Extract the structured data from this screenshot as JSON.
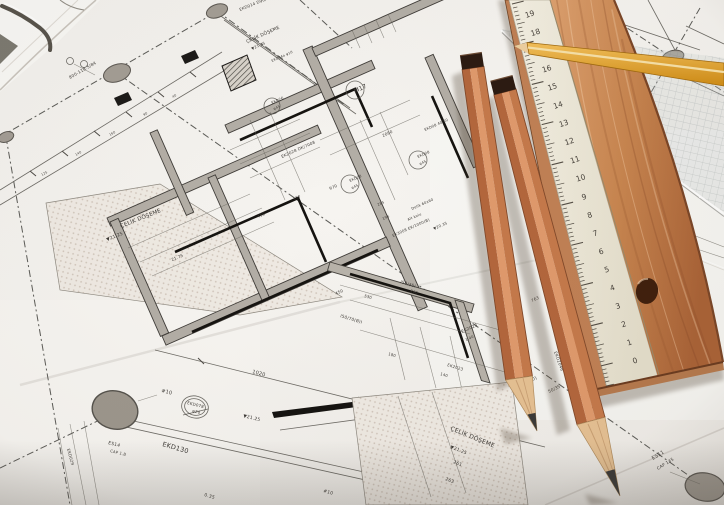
{
  "scene": {
    "width": 724,
    "height": 505,
    "subject": "architectural blueprint with pencils, wooden ruler, scale ruler and set square"
  },
  "colors": {
    "paper": "#f4f2ee",
    "line": "#55524c",
    "wall_fill": "#b3aea6",
    "pencil_left": "#b3663c",
    "pencil_mid": "#e09a6c",
    "pencil_right": "#c5794a",
    "pencil_cap": "#2b1a11",
    "cone_wood": "#e6c193",
    "graphite": "#3a3a38",
    "ruler_wood": "#c98a5e",
    "ruler_side": "#c08054",
    "scale_face": "#f1ecdd",
    "yellow_pencil": "#e8a83c"
  },
  "blueprint": {
    "plan_labels": [
      {
        "t": "EKD014 D90/75",
        "x": 240,
        "y": 11,
        "r": -22,
        "s": 4
      },
      {
        "t": "ÇELİK DÖŞEME",
        "x": 247,
        "y": 43,
        "r": -24,
        "s": 4.5
      },
      {
        "t": "▼21.25",
        "x": 252,
        "y": 50,
        "r": -24,
        "s": 3.8
      },
      {
        "t": "800-118.5/84",
        "x": 70,
        "y": 79,
        "r": -30,
        "s": 4.2
      },
      {
        "t": "M17",
        "x": 355,
        "y": 93,
        "r": -24,
        "s": 6
      },
      {
        "t": "EKD26",
        "x": 272,
        "y": 104,
        "r": -24,
        "s": 3.6
      },
      {
        "t": "φ45",
        "x": 274,
        "y": 110,
        "r": -24,
        "s": 3.4
      },
      {
        "t": "EKD08 40/50",
        "x": 425,
        "y": 131,
        "r": -24,
        "s": 3.6
      },
      {
        "t": "2060",
        "x": 383,
        "y": 137,
        "r": -24,
        "s": 4
      },
      {
        "t": "EK2028 DK/7008",
        "x": 282,
        "y": 158,
        "r": -24,
        "s": 4
      },
      {
        "t": "EKD04a φ10",
        "x": 272,
        "y": 62,
        "r": -24,
        "s": 3.4
      },
      {
        "t": "970",
        "x": 330,
        "y": 190,
        "r": -24,
        "s": 4
      },
      {
        "t": "EKD28",
        "x": 350,
        "y": 182,
        "r": -24,
        "s": 3.6
      },
      {
        "t": "φ45",
        "x": 352,
        "y": 189,
        "r": -24,
        "s": 3.4
      },
      {
        "t": "EKD08",
        "x": 418,
        "y": 158,
        "r": -24,
        "s": 3.6
      },
      {
        "t": "φ45",
        "x": 420,
        "y": 165,
        "r": -24,
        "s": 3.4
      },
      {
        "t": "ÇELİK DÖŞEME",
        "x": 121,
        "y": 228,
        "r": -22,
        "s": 5.5
      },
      {
        "t": "▼21.25",
        "x": 107,
        "y": 241,
        "r": -22,
        "s": 4.5
      },
      {
        "t": "450",
        "x": 258,
        "y": 218,
        "r": -24,
        "s": 4
      },
      {
        "t": "150",
        "x": 294,
        "y": 200,
        "r": -24,
        "s": 3.6
      },
      {
        "t": "285",
        "x": 378,
        "y": 206,
        "r": -24,
        "s": 3.6
      },
      {
        "t": "196",
        "x": 383,
        "y": 220,
        "r": -24,
        "s": 3.6
      },
      {
        "t": "Delik 60x60",
        "x": 412,
        "y": 210,
        "r": -24,
        "s": 3.6
      },
      {
        "t": "Alt kolu",
        "x": 408,
        "y": 221,
        "r": -24,
        "s": 3.6
      },
      {
        "t": "▼20.35",
        "x": 434,
        "y": 230,
        "r": -24,
        "s": 3.8
      },
      {
        "t": "EK3008 EK/1000(B)",
        "x": 393,
        "y": 237,
        "r": -24,
        "s": 3.8
      },
      {
        "t": "21.75",
        "x": 172,
        "y": 261,
        "r": -22,
        "s": 4
      },
      {
        "t": "450",
        "x": 336,
        "y": 295,
        "r": -24,
        "s": 4
      },
      {
        "t": "763",
        "x": 532,
        "y": 302,
        "r": -24,
        "s": 4
      },
      {
        "t": "EKD2046",
        "x": 554,
        "y": 352,
        "r": 70,
        "s": 4.2
      },
      {
        "t": "EK2023",
        "x": 462,
        "y": 333,
        "r": -24,
        "s": 4.2
      },
      {
        "t": "1.40",
        "x": 466,
        "y": 341,
        "r": -24,
        "s": 3.6
      },
      {
        "t": "(50/35-50)",
        "x": 514,
        "y": 390,
        "r": -26,
        "s": 4.5
      },
      {
        "t": "50/35",
        "x": 549,
        "y": 393,
        "r": -26,
        "s": 4.2
      },
      {
        "t": "ES11",
        "x": 653,
        "y": 460,
        "r": -32,
        "s": 5
      },
      {
        "t": "CAP 135",
        "x": 658,
        "y": 470,
        "r": -32,
        "s": 4.2
      },
      {
        "t": "125",
        "x": 42,
        "y": 176,
        "r": -30,
        "s": 3.2
      },
      {
        "t": "140",
        "x": 76,
        "y": 156,
        "r": -30,
        "s": 3.2
      },
      {
        "t": "160",
        "x": 110,
        "y": 136,
        "r": -30,
        "s": 3.2
      },
      {
        "t": "90",
        "x": 144,
        "y": 116,
        "r": -30,
        "s": 3.2
      },
      {
        "t": "40",
        "x": 173,
        "y": 98,
        "r": -30,
        "s": 3.2
      },
      {
        "t": "1020",
        "x": 252,
        "y": 373,
        "r": 15,
        "s": 5
      },
      {
        "t": "#10",
        "x": 161,
        "y": 392,
        "r": 14,
        "s": 5
      },
      {
        "t": "EKD078",
        "x": 187,
        "y": 404,
        "r": 14,
        "s": 4
      },
      {
        "t": "φ20",
        "x": 192,
        "y": 412,
        "r": 14,
        "s": 4
      },
      {
        "t": "▼21.25",
        "x": 243,
        "y": 417,
        "r": 14,
        "s": 4.5
      },
      {
        "t": "EKD130",
        "x": 162,
        "y": 446,
        "r": 16,
        "s": 6.5
      },
      {
        "t": "ES14",
        "x": 108,
        "y": 444,
        "r": 14,
        "s": 4.5
      },
      {
        "t": "CAP 1.B",
        "x": 110,
        "y": 452,
        "r": 14,
        "s": 3.8
      },
      {
        "t": "EKD029",
        "x": 67,
        "y": 449,
        "r": 75,
        "s": 4
      },
      {
        "t": "I50/70(B)I",
        "x": 340,
        "y": 317,
        "r": 17,
        "s": 4.2
      },
      {
        "t": "I50/35I",
        "x": 400,
        "y": 283,
        "r": 17,
        "s": 4.2
      },
      {
        "t": "530",
        "x": 364,
        "y": 297,
        "r": 17,
        "s": 3.8
      },
      {
        "t": "260",
        "x": 410,
        "y": 292,
        "r": 17,
        "s": 3.8
      },
      {
        "t": "180",
        "x": 388,
        "y": 355,
        "r": 17,
        "s": 3.8
      },
      {
        "t": "140",
        "x": 440,
        "y": 375,
        "r": 17,
        "s": 3.8
      },
      {
        "t": "EK2023",
        "x": 447,
        "y": 366,
        "r": 17,
        "s": 4
      },
      {
        "t": "ÇELİK DÖŞEME",
        "x": 450,
        "y": 430,
        "r": 22,
        "s": 6
      },
      {
        "t": "▼21.25",
        "x": 450,
        "y": 448,
        "r": 22,
        "s": 4.5
      },
      {
        "t": "261",
        "x": 453,
        "y": 463,
        "r": 22,
        "s": 4.5
      },
      {
        "t": "263",
        "x": 445,
        "y": 480,
        "r": 22,
        "s": 4.5
      },
      {
        "t": "0.35",
        "x": 204,
        "y": 496,
        "r": 16,
        "s": 4.5
      },
      {
        "t": "#10",
        "x": 323,
        "y": 492,
        "r": 16,
        "s": 4.5
      }
    ]
  },
  "objects": {
    "white_ruler": {
      "numbers": [
        "19",
        "18",
        "17",
        "16",
        "15",
        "14",
        "13",
        "12",
        "11",
        "10",
        "9",
        "8",
        "7",
        "6",
        "5",
        "4",
        "3",
        "2",
        "1",
        "0"
      ]
    }
  }
}
